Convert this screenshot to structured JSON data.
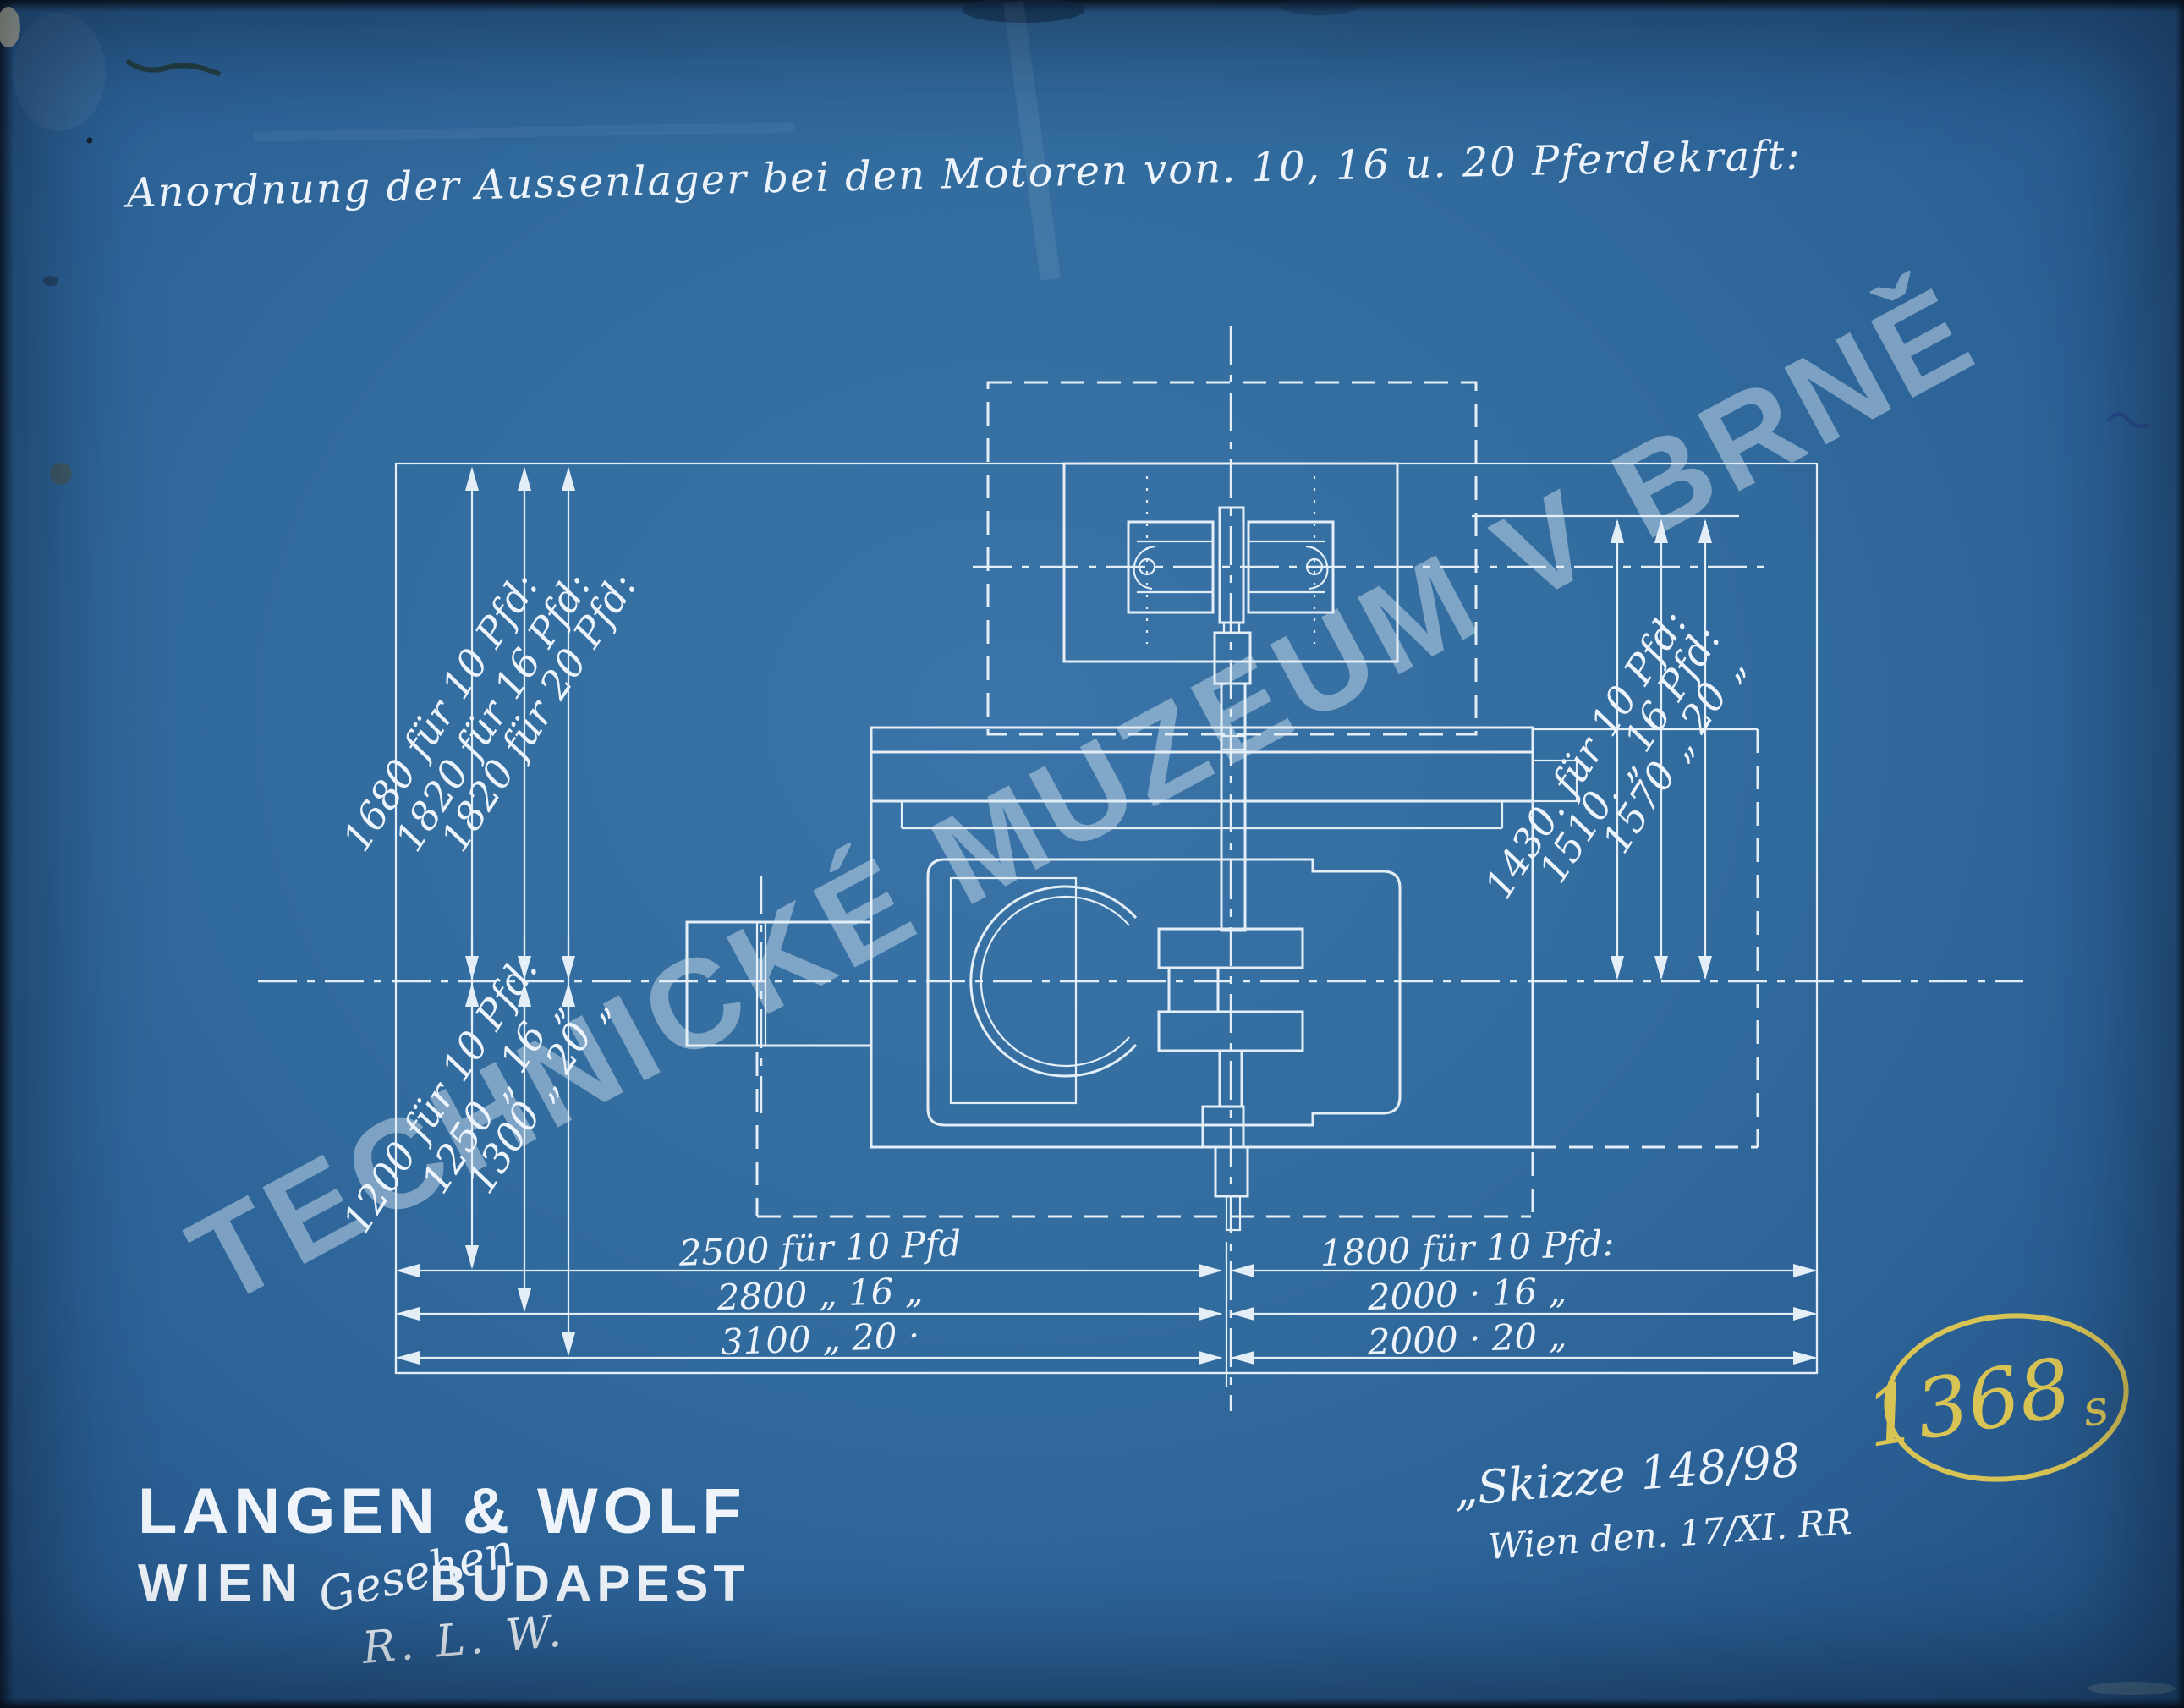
{
  "sheet": {
    "title": "Anordnung der Aussenlager bei den Motoren von. 10, 16 u. 20 Pferdekraft:",
    "watermark": "TECHNICKÉ MUZEUM V BRNĚ",
    "inventory": {
      "number": "1368",
      "suffix": "s"
    },
    "sketch": {
      "line1": "„Skizze 148/98",
      "line2": "Wien den. 17/XI. RR"
    },
    "stamp": {
      "name": "LANGEN & WOLF",
      "city_left": "WIEN",
      "middle": "Gesehen",
      "city_right": "BUDAPEST",
      "initials": "R. L. W."
    }
  },
  "dimensions": {
    "left_upper": [
      "1680 für 10 Pfd:",
      "1820 für 16 Pfd:",
      "1820 für 20 Pfd:"
    ],
    "left_lower": [
      "1200 für 10 Pfd:",
      "1250 „ 16 „",
      "1300 „ 20 „"
    ],
    "right_column": [
      "1430. für 10 Pfd:",
      "1510. „ 16 Pfd:",
      "1570 „ 20 „"
    ],
    "bottom_left": [
      "2500 für 10 Pfd",
      "2800 „ 16 „",
      "3100 „ 20 ·"
    ],
    "bottom_right": [
      "1800 für 10 Pfd:",
      "2000 · 16 „",
      "2000 · 20 „"
    ]
  },
  "colors": {
    "paper": "#31699d",
    "line": "#e4eef7",
    "watermark": "#c9dcec",
    "stamp_yellow": "#d8c355"
  }
}
